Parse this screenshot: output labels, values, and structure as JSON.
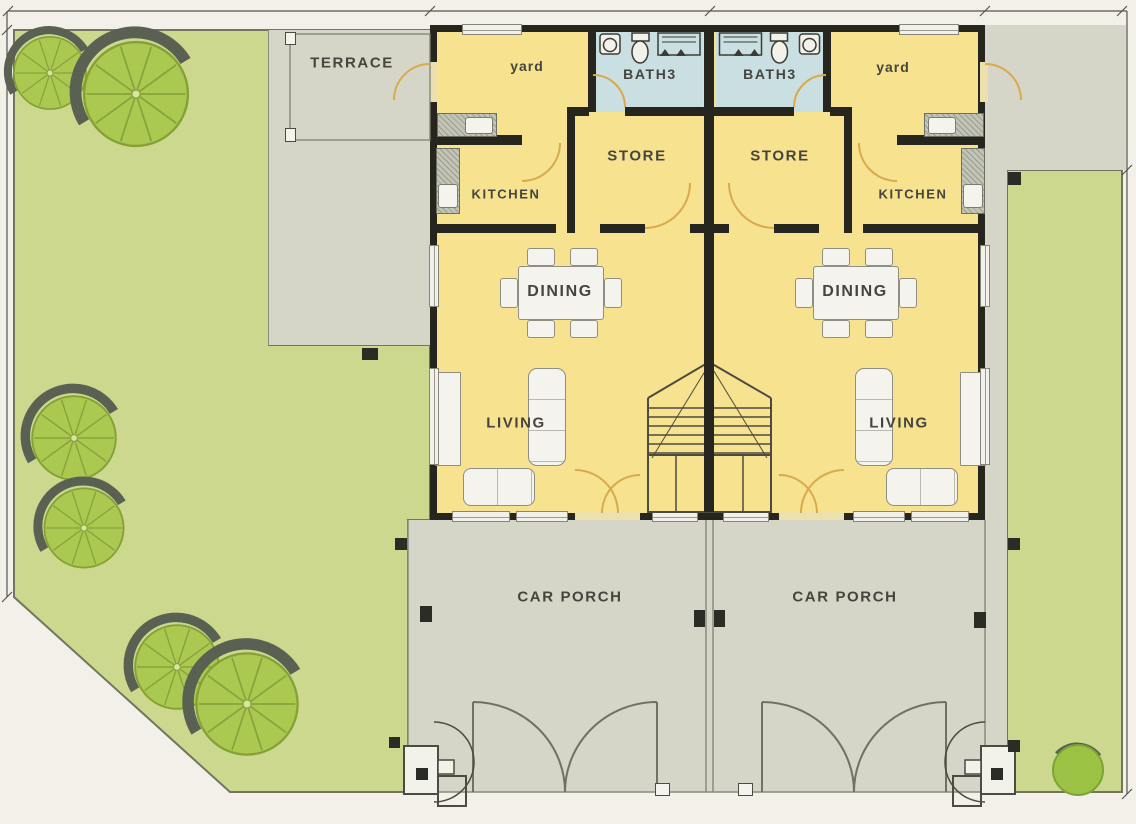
{
  "plan": {
    "labels": {
      "terrace": "TERRACE",
      "yard": "yard",
      "bath3": "BATH3",
      "store": "STORE",
      "kitchen": "KITCHEN",
      "dining": "DINING",
      "living": "LIVING",
      "car_porch": "CAR PORCH"
    },
    "label_instances": [
      {
        "room": "terrace",
        "unit": "left-side"
      },
      {
        "room": "yard",
        "unit": "left"
      },
      {
        "room": "yard",
        "unit": "right"
      },
      {
        "room": "bath3",
        "unit": "left"
      },
      {
        "room": "bath3",
        "unit": "right"
      },
      {
        "room": "store",
        "unit": "left"
      },
      {
        "room": "store",
        "unit": "right"
      },
      {
        "room": "kitchen",
        "unit": "left"
      },
      {
        "room": "kitchen",
        "unit": "right"
      },
      {
        "room": "dining",
        "unit": "left"
      },
      {
        "room": "dining",
        "unit": "right"
      },
      {
        "room": "living",
        "unit": "left"
      },
      {
        "room": "living",
        "unit": "right"
      },
      {
        "room": "car_porch",
        "unit": "left"
      },
      {
        "room": "car_porch",
        "unit": "right"
      }
    ],
    "site": {
      "trees": 6,
      "bushes": 1,
      "units": 2
    },
    "colors": {
      "page": "#f2f0e9",
      "lawn": "#ccd88d",
      "tree": "#abc851",
      "tree_shadow": "#5b6152",
      "interior": "#f6e28f",
      "bath": "#c9dfe2",
      "hardscape": "#d5d6c8",
      "wall": "#26261f",
      "door_arc": "#d9a94c",
      "text": "#45453e",
      "line": "#72755f"
    },
    "icons": {
      "tree": "tree-icon",
      "bush": "bush-icon",
      "sink": "sink-icon",
      "toilet": "toilet-icon",
      "shower": "shower-icon",
      "door_swing": "door-swing-arc",
      "staircase": "staircase-icon",
      "gate": "gate-arc-icon",
      "dimension": "dimension-line"
    }
  }
}
